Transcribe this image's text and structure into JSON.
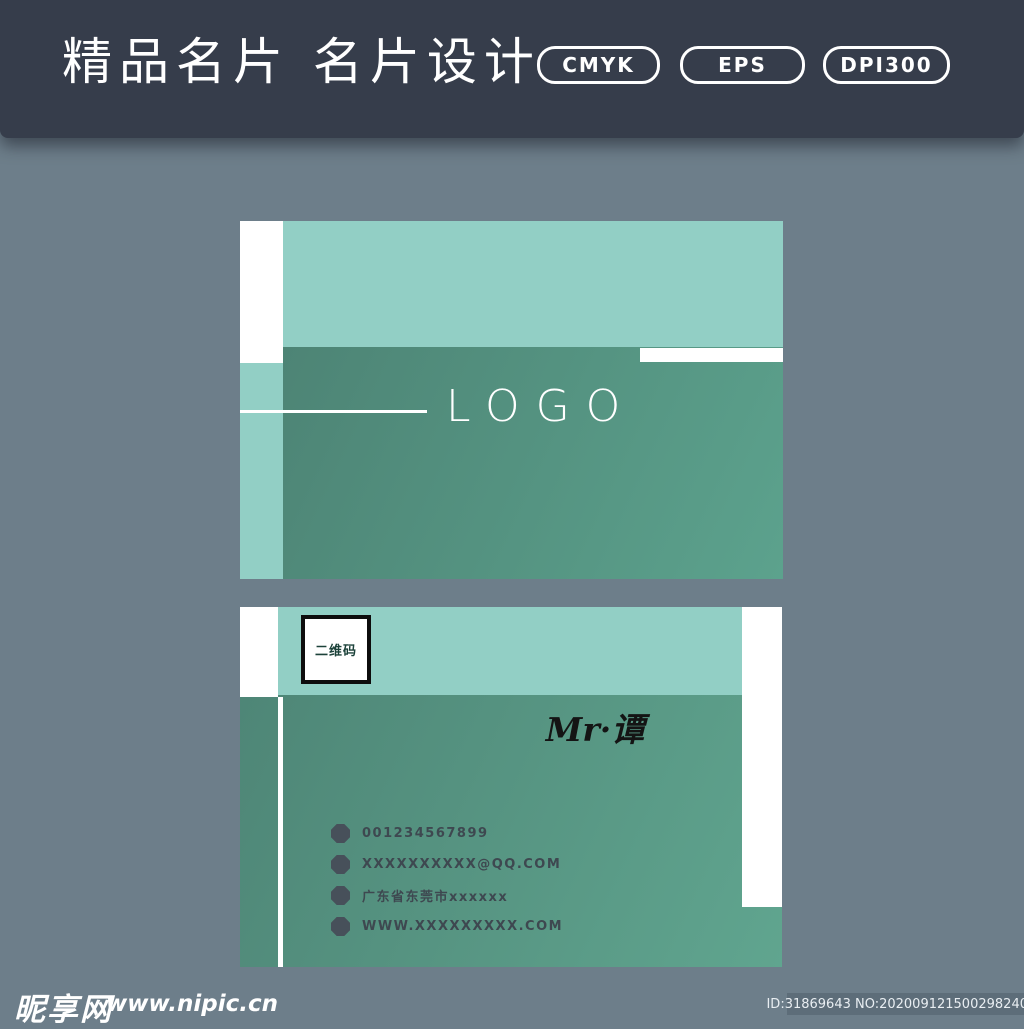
{
  "header": {
    "title": "精品名片 名片设计",
    "badges": [
      {
        "label": "CMYK"
      },
      {
        "label": "EPS"
      },
      {
        "label": "DPI300"
      }
    ]
  },
  "card_front": {
    "logo_text": "LOGO"
  },
  "card_back": {
    "qr_label": "二维码",
    "person_name": "Mr·谭",
    "contacts": [
      {
        "text": "001234567899"
      },
      {
        "text": "XXXXXXXXXX@QQ.COM"
      },
      {
        "text": "广东省东莞市xxxxxx"
      },
      {
        "text": "WWW.XXXXXXXXX.COM"
      }
    ]
  },
  "footer": {
    "site_name": "昵享网",
    "site_url": "www.nipic.cn",
    "image_id": "ID:31869643 NO:20200912150029824000"
  },
  "colors": {
    "header_bg": "#363d4b",
    "page_bg": "#6d7e8a",
    "teal_light": "#92cfc5",
    "green_gradient_start": "#4d8475",
    "green_gradient_end": "#5ca28d",
    "contact_text": "#3e4850",
    "footer_id_bg": "#5d6d79",
    "white": "#ffffff"
  }
}
